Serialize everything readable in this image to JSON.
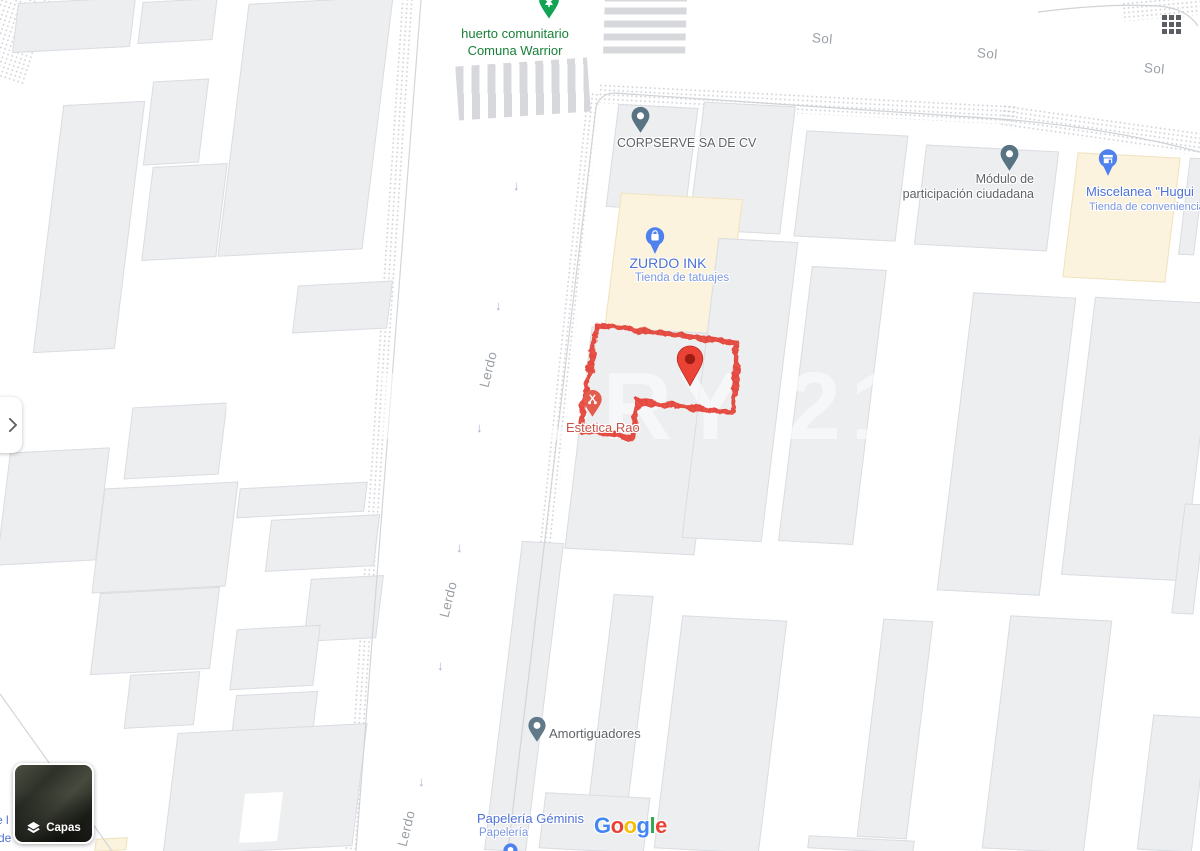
{
  "map": {
    "streets": {
      "vertical_street": "Lerdo",
      "horizontal_street": "Sol"
    },
    "arrow_glyph": "↓",
    "pois": {
      "huerto": {
        "line1": "huerto comunitario",
        "line2": "Comuna Warrior"
      },
      "corpserve": {
        "name": "CORPSERVE SA DE CV"
      },
      "modulo": {
        "line1": "Módulo de",
        "line2": "participación ciudadana"
      },
      "miscelanea": {
        "name": "Miscelanea \"Hugui",
        "subtitle": "Tienda de conveniencia"
      },
      "zurdo": {
        "name": "ZURDO INK",
        "subtitle": "Tienda de tatuajes"
      },
      "estetica": {
        "name": "Estetica Rao"
      },
      "amortiguadores": {
        "name": "Amortiguadores"
      },
      "papeleria": {
        "name": "Papelería Géminis",
        "subtitle": "Papelería"
      }
    },
    "watermark": "CENTURY 21",
    "edge_fragments": {
      "line1": "e l",
      "line2": "de"
    },
    "colors": {
      "poi_blue": "#4E80EE",
      "poi_text_blue": "#4D72D6",
      "poi_text_blue_light": "#7B97DF",
      "park_green": "#12A454",
      "park_text_green": "#188038",
      "street_label_gray": "#9AA0A6",
      "poi_label_gray": "#5F6368",
      "marker_red": "#EA4335",
      "parcel_outline_red": "#E2392F",
      "estetica_text_red": "#C5544B",
      "poi_building_cream": "#FBF3DD",
      "building_gray": "#ECEEF0"
    }
  },
  "controls": {
    "layers_label": "Capas"
  },
  "attribution": {
    "letters": [
      "G",
      "o",
      "o",
      "g",
      "l",
      "e"
    ]
  }
}
